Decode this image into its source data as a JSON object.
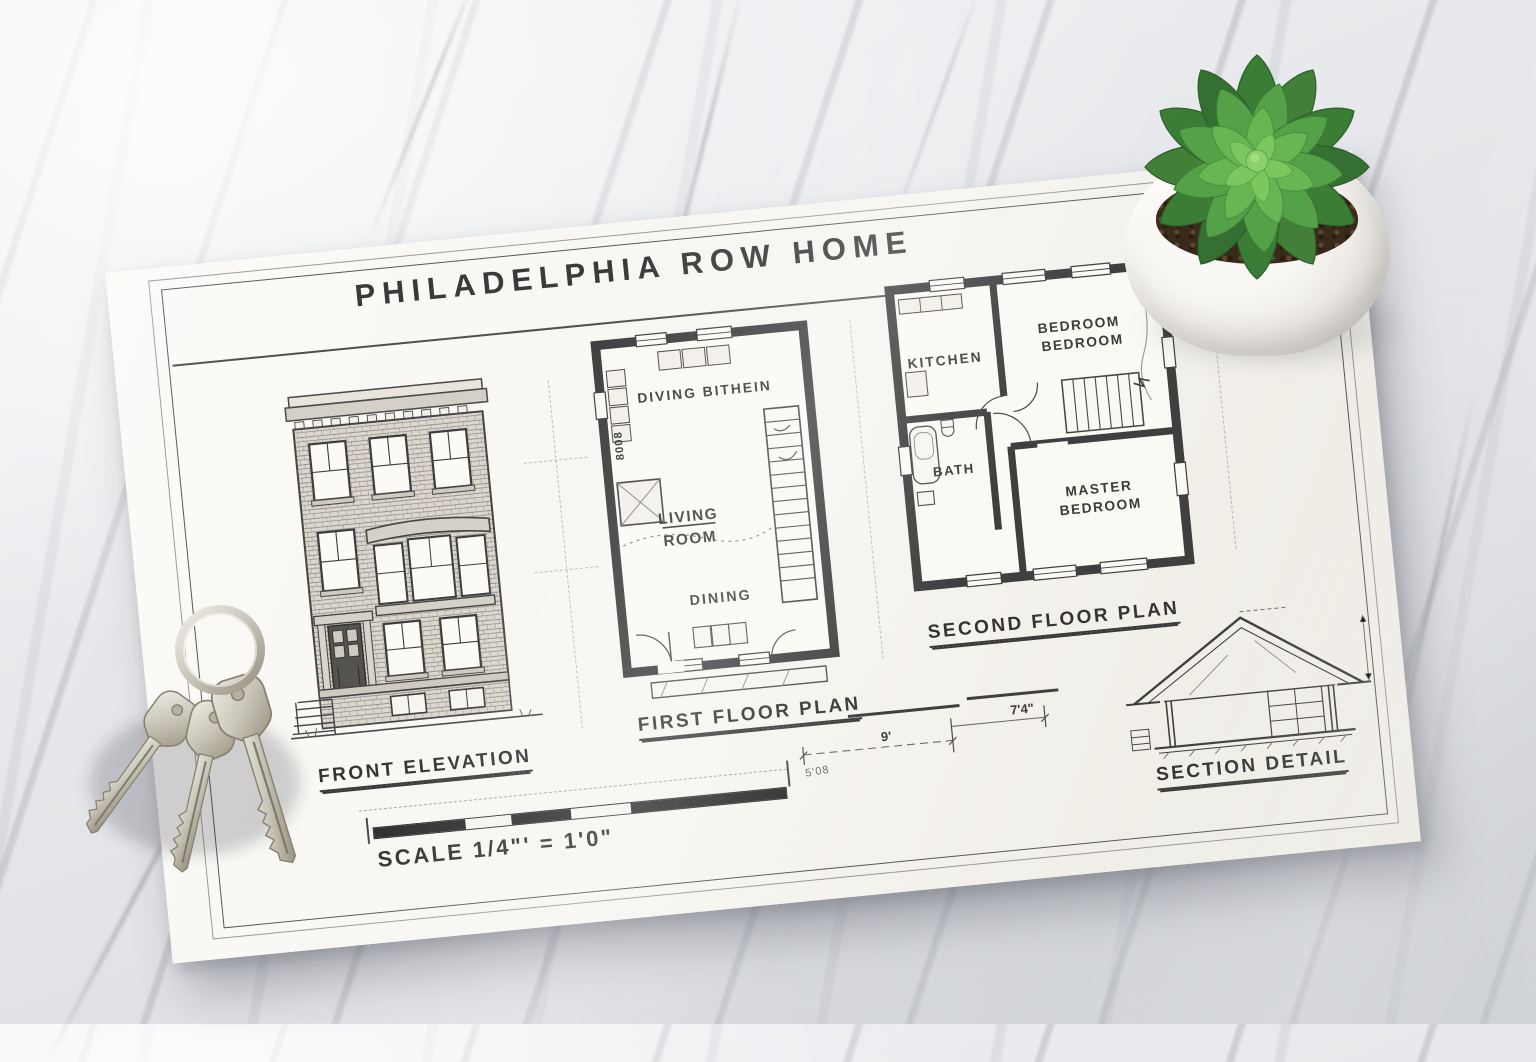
{
  "sheet": {
    "title": "PHILADELPHIA ROW HOME",
    "front_elevation": {
      "caption": "FRONT ELEVATION"
    },
    "first_floor_plan": {
      "caption": "FIRST FLOOR PLAN",
      "room_top": "DIVING  BITHEIN",
      "room_living_1": "LIVING",
      "room_living_2": "ROOM",
      "room_dining": "DINING",
      "counter_mark": "8008"
    },
    "second_floor_plan": {
      "caption": "SECOND FLOOR PLAN",
      "room_kitchen": "KITCHEN",
      "room_bedroom_1": "BEDROOM",
      "room_bedroom_2": "BEDROOM",
      "room_bath": "BATH",
      "room_master_1": "MASTER",
      "room_master_2": "BEDROOM"
    },
    "section_detail": {
      "caption": "SECTION DETAIL"
    },
    "scale_note": "SCALE 1/4\"' = 1'0\"",
    "dimensions": {
      "dim_a": "9'",
      "dim_b": "7'4\"",
      "scale_tick": "5'08"
    }
  },
  "colors": {
    "paper": "#f6f4ef",
    "ink": "#3a3a3a",
    "marble": "#e8eaec",
    "succulent_green": "#57a34a",
    "pot_white": "#f4f2ee",
    "key_silver": "#bab6aa"
  }
}
